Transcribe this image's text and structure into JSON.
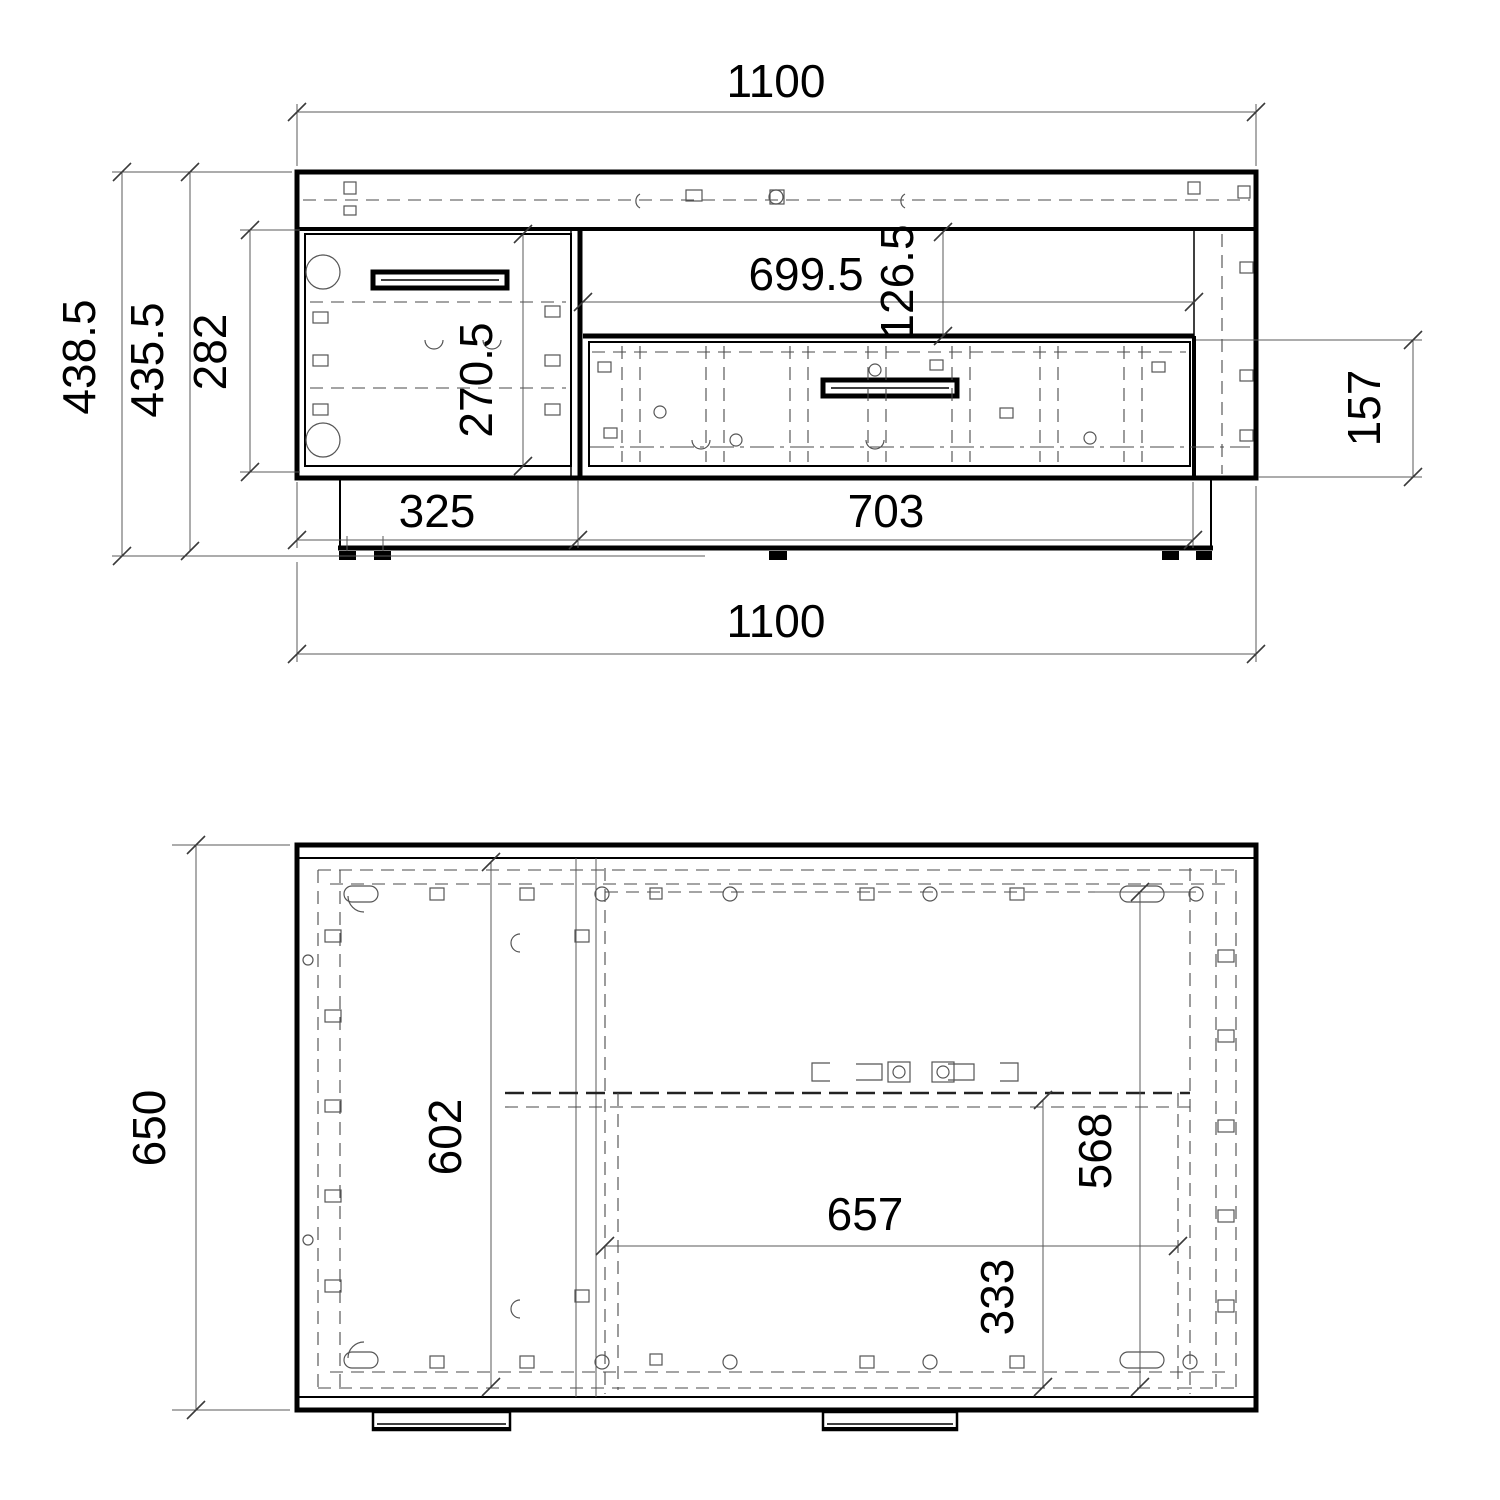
{
  "drawing": {
    "background_color": "#ffffff",
    "line_color": "#000000",
    "dim_line_color": "#585858"
  },
  "dims": {
    "front": {
      "width_top": "1100",
      "height_total": "438.5",
      "height_body": "435.5",
      "interior_height": "282",
      "door_height": "270.5",
      "niche_width": "699.5",
      "niche_height": "126.5",
      "drawer_front_height": "157",
      "plinth_left": "325",
      "plinth_right": "703",
      "width_bottom": "1100"
    },
    "plan": {
      "depth": "650",
      "interior_depth": "602",
      "drawer_width": "657",
      "drawer_back_inset": "333",
      "drawer_depth": "568"
    }
  }
}
